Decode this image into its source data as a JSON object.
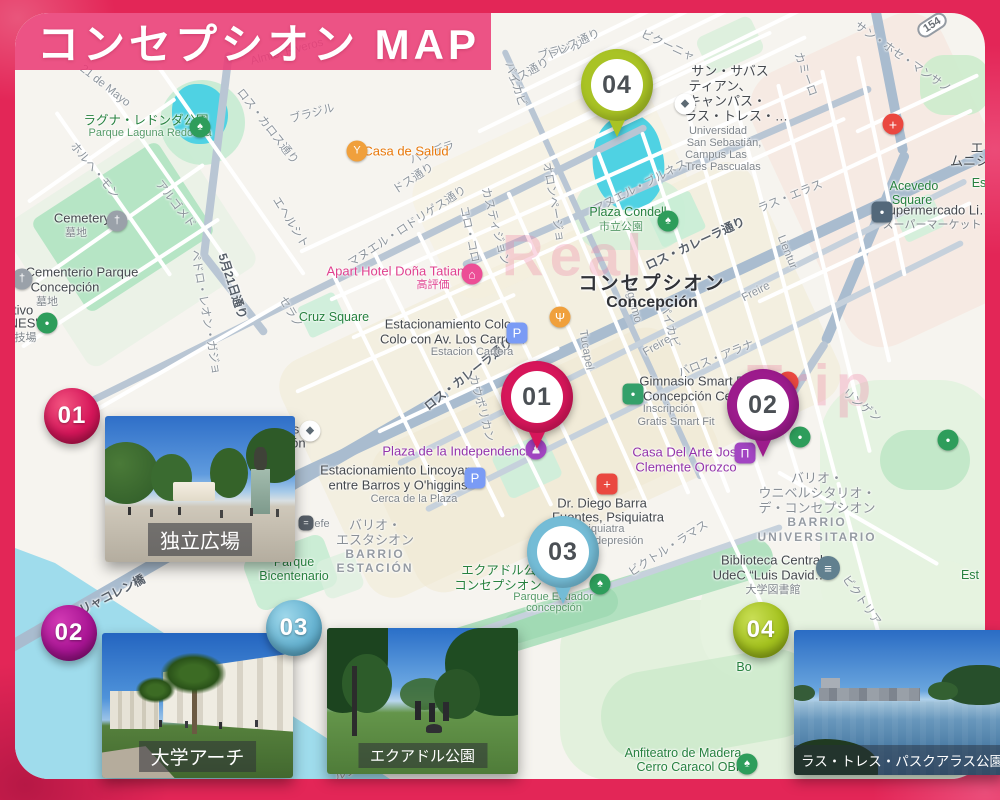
{
  "title": "コンセプシオン MAP",
  "frame_color": "#e32657",
  "banner_color": "#ec3c76",
  "map": {
    "route_shield": "154",
    "watermarks": [
      {
        "text": "Real",
        "x": 575,
        "y": 256
      },
      {
        "text": "Trip",
        "x": 812,
        "y": 386
      }
    ],
    "labels": [
      {
        "t": "21 de Mayo",
        "x": 105,
        "y": 86,
        "r": 38
      },
      {
        "t": "ロス・カロス通り",
        "x": 268,
        "y": 126,
        "r": 52
      },
      {
        "t": "ホルヘ・モン",
        "x": 95,
        "y": 170,
        "r": 50
      },
      {
        "t": "アルゴメド",
        "x": 176,
        "y": 204,
        "r": 52
      },
      {
        "t": "エヘルシト",
        "x": 291,
        "y": 222,
        "r": 58
      },
      {
        "t": "セラノ",
        "x": 291,
        "y": 312,
        "r": 60
      },
      {
        "t": "ペドロ・レオン・ガジョ",
        "x": 206,
        "y": 312,
        "r": 80
      },
      {
        "t": "5月21日通り",
        "x": 233,
        "y": 286,
        "r": 72,
        "c": "std"
      },
      {
        "t": "ドス通り",
        "x": 413,
        "y": 178,
        "r": -33
      },
      {
        "t": "バンデラ",
        "x": 432,
        "y": 152,
        "r": -20
      },
      {
        "t": "ブラジル",
        "x": 312,
        "y": 113,
        "r": -15
      },
      {
        "t": "ブラジル",
        "x": 560,
        "y": 50,
        "r": -15
      },
      {
        "t": "ドス通り",
        "x": 528,
        "y": 72,
        "r": -30
      },
      {
        "t": "トレス通り",
        "x": 573,
        "y": 44,
        "r": -25
      },
      {
        "t": "ビクーニャ",
        "x": 668,
        "y": 45,
        "r": 25
      },
      {
        "t": "カミーロ",
        "x": 806,
        "y": 74,
        "r": 70
      },
      {
        "t": "サン・ホセ・マンサノ",
        "x": 903,
        "y": 57,
        "r": 35
      },
      {
        "t": "パイカビ",
        "x": 516,
        "y": 84,
        "r": 72
      },
      {
        "t": "パイカビ",
        "x": 670,
        "y": 325,
        "r": 75
      },
      {
        "t": "マヌエル・ロドリゲス通り",
        "x": 407,
        "y": 226,
        "r": -33
      },
      {
        "t": "カスティジョン",
        "x": 496,
        "y": 226,
        "r": 75
      },
      {
        "t": "コロ・コロ",
        "x": 470,
        "y": 234,
        "r": 78
      },
      {
        "t": "オロンページョ",
        "x": 554,
        "y": 202,
        "r": 80
      },
      {
        "t": "マヌエル・ブルネス",
        "x": 640,
        "y": 186,
        "r": -27
      },
      {
        "t": "ラス・エラス",
        "x": 790,
        "y": 196,
        "r": -22
      },
      {
        "t": "Lientur",
        "x": 787,
        "y": 252,
        "r": 68
      },
      {
        "t": "Freire",
        "x": 756,
        "y": 292,
        "r": -27
      },
      {
        "t": "Freire",
        "x": 657,
        "y": 346,
        "r": -30
      },
      {
        "t": "バロス・アラナ",
        "x": 716,
        "y": 358,
        "r": -22
      },
      {
        "t": "Ongolmo",
        "x": 632,
        "y": 300,
        "r": 75
      },
      {
        "t": "Tucapel",
        "x": 586,
        "y": 350,
        "r": 80
      },
      {
        "t": "ロス・カレーラ通り",
        "x": 695,
        "y": 243,
        "r": -25,
        "c": "std"
      },
      {
        "t": "ロス・カレーラ通り",
        "x": 468,
        "y": 374,
        "r": -38,
        "c": "std"
      },
      {
        "t": "カウポリカン",
        "x": 482,
        "y": 408,
        "r": 75
      },
      {
        "t": "リャコレン橋",
        "x": 112,
        "y": 594,
        "r": -27,
        "c": "std"
      },
      {
        "t": "ビクトル・ラマス",
        "x": 668,
        "y": 548,
        "r": -33
      },
      {
        "t": "ビクトリア",
        "x": 862,
        "y": 600,
        "r": 55
      },
      {
        "t": "リンゲン",
        "x": 862,
        "y": 405,
        "r": 38
      },
      {
        "t": "ルシーン",
        "x": 356,
        "y": 769,
        "r": -20
      },
      {
        "t": "チャカブコ",
        "x": 258,
        "y": 712,
        "r": -35
      },
      {
        "t": "Almte. Riveros",
        "x": 287,
        "y": 52,
        "r": -15
      },
      {
        "t": "ラグナ・レドンダ公園",
        "x": 146,
        "y": 119,
        "c": "pk"
      },
      {
        "t": "Parque Laguna Redonda",
        "x": 150,
        "y": 133,
        "c": "pks"
      },
      {
        "t": "Cruz Square",
        "x": 334,
        "y": 317,
        "c": "pk"
      },
      {
        "t": "Plaza Condell",
        "x": 628,
        "y": 212,
        "c": "pk"
      },
      {
        "t": "市立公園",
        "x": 621,
        "y": 226,
        "c": "pks"
      },
      {
        "t": "Acevedo",
        "x": 914,
        "y": 186,
        "c": "pk"
      },
      {
        "t": "Square",
        "x": 912,
        "y": 200,
        "c": "pk"
      },
      {
        "t": "Parque",
        "x": 294,
        "y": 562,
        "c": "pk"
      },
      {
        "t": "Bicentenario",
        "x": 294,
        "y": 576,
        "c": "pk"
      },
      {
        "t": "エクアドル公園",
        "x": 505,
        "y": 569,
        "c": "pk"
      },
      {
        "t": "コンセプシオン",
        "x": 498,
        "y": 584,
        "c": "pk"
      },
      {
        "t": "Parque Ecuador",
        "x": 553,
        "y": 597,
        "c": "pks"
      },
      {
        "t": "concepción",
        "x": 554,
        "y": 608,
        "c": "pks"
      },
      {
        "t": "Anfiteatro de Madera",
        "x": 683,
        "y": 753,
        "c": "pk"
      },
      {
        "t": "Cerro Caracol OBF",
        "x": 690,
        "y": 767,
        "c": "pk"
      },
      {
        "t": "Bo",
        "x": 744,
        "y": 667,
        "c": "pk"
      },
      {
        "t": "ster",
        "x": 966,
        "y": 755,
        "c": "pk"
      },
      {
        "t": "Est",
        "x": 970,
        "y": 575,
        "c": "pk"
      },
      {
        "t": "Es",
        "x": 979,
        "y": 183,
        "c": "pk"
      },
      {
        "t": "Cemetery",
        "x": 82,
        "y": 218,
        "c": "poi"
      },
      {
        "t": "墓地",
        "x": 76,
        "y": 232,
        "c": "pois"
      },
      {
        "t": "Cementerio Parque",
        "x": 82,
        "y": 272,
        "c": "poi"
      },
      {
        "t": "Concepción",
        "x": 65,
        "y": 287,
        "c": "poi"
      },
      {
        "t": "墓地",
        "x": 47,
        "y": 301,
        "c": "pois"
      },
      {
        "t": "rtivo",
        "x": 21,
        "y": 310,
        "c": "poi"
      },
      {
        "t": "'NES'",
        "x": 22,
        "y": 323,
        "c": "poi"
      },
      {
        "t": "球技場",
        "x": 20,
        "y": 337,
        "c": "pois"
      },
      {
        "t": "Estacionamiento Colo",
        "x": 448,
        "y": 324,
        "c": "poi"
      },
      {
        "t": "Colo con Av. Los Carrera",
        "x": 452,
        "y": 339,
        "c": "poi"
      },
      {
        "t": "Estacion Carrera",
        "x": 472,
        "y": 352,
        "c": "pois"
      },
      {
        "t": "Estacionamiento Lincoyan",
        "x": 396,
        "y": 470,
        "c": "poi"
      },
      {
        "t": "entre Barros y O'higgins",
        "x": 398,
        "y": 485,
        "c": "poi"
      },
      {
        "t": "Cerca de la Plaza",
        "x": 414,
        "y": 499,
        "c": "pois"
      },
      {
        "t": "to Tomás",
        "x": 273,
        "y": 429,
        "c": "poi"
      },
      {
        "t": "oncepción",
        "x": 276,
        "y": 443,
        "c": "poi"
      },
      {
        "t": "コンセプシオン",
        "x": 652,
        "y": 282,
        "c": "city"
      },
      {
        "t": "Concepción",
        "x": 652,
        "y": 303,
        "c": "city2"
      },
      {
        "t": "サン・サバス",
        "x": 730,
        "y": 70,
        "c": "poi"
      },
      {
        "t": "ティアン、",
        "x": 720,
        "y": 85,
        "c": "poi"
      },
      {
        "t": "キャンパス・",
        "x": 727,
        "y": 100,
        "c": "poi"
      },
      {
        "t": "ラス・トレス・…",
        "x": 736,
        "y": 115,
        "c": "poi"
      },
      {
        "t": "Universidad",
        "x": 718,
        "y": 131,
        "c": "pois"
      },
      {
        "t": "San Sebastián,",
        "x": 724,
        "y": 143,
        "c": "pois"
      },
      {
        "t": "Campus Las",
        "x": 716,
        "y": 155,
        "c": "pois"
      },
      {
        "t": "Tres Pascualas",
        "x": 723,
        "y": 167,
        "c": "pois"
      },
      {
        "t": "Gimnasio Smart Fit",
        "x": 695,
        "y": 381,
        "c": "poi"
      },
      {
        "t": "- Concepción Ce…",
        "x": 690,
        "y": 396,
        "c": "poi"
      },
      {
        "t": "Inscripción",
        "x": 669,
        "y": 409,
        "c": "pois"
      },
      {
        "t": "Gratis Smart Fit",
        "x": 676,
        "y": 422,
        "c": "pois"
      },
      {
        "t": "Dr. Diego Barra",
        "x": 602,
        "y": 503,
        "c": "poi"
      },
      {
        "t": "Fuentes, Psiquiatra",
        "x": 608,
        "y": 517,
        "c": "poi"
      },
      {
        "t": "Psiquiatra",
        "x": 600,
        "y": 529,
        "c": "pois"
      },
      {
        "t": "…dad depresión",
        "x": 603,
        "y": 541,
        "c": "pois"
      },
      {
        "t": "Biblioteca Central",
        "x": 772,
        "y": 560,
        "c": "poi"
      },
      {
        "t": "UdeC “Luis David…",
        "x": 770,
        "y": 575,
        "c": "poi"
      },
      {
        "t": "大学図書館",
        "x": 773,
        "y": 589,
        "c": "pois"
      },
      {
        "t": "Supermercado Li…",
        "x": 936,
        "y": 210,
        "c": "poi"
      },
      {
        "t": "スーパーマーケット",
        "x": 932,
        "y": 224,
        "c": "pois"
      },
      {
        "t": "efe",
        "x": 322,
        "y": 524,
        "c": "pois"
      },
      {
        "t": "エ",
        "x": 977,
        "y": 147,
        "c": "poi"
      },
      {
        "t": "ムニシ…",
        "x": 976,
        "y": 160,
        "c": "poi"
      },
      {
        "t": "Apart Hotel Doña Tatiana",
        "x": 399,
        "y": 271,
        "c": "hot"
      },
      {
        "t": "高評価",
        "x": 433,
        "y": 284,
        "c": "hots"
      },
      {
        "t": "Casa de Salud",
        "x": 406,
        "y": 151,
        "c": "org"
      },
      {
        "t": "Plaza de la Independencia",
        "x": 459,
        "y": 451,
        "c": "pur"
      },
      {
        "t": "Casa Del Arte José",
        "x": 688,
        "y": 452,
        "c": "pur"
      },
      {
        "t": "Clemente Orozco",
        "x": 686,
        "y": 467,
        "c": "pur"
      },
      {
        "t": "バリオ・",
        "x": 817,
        "y": 477,
        "c": "ar"
      },
      {
        "t": "ウニベルシタリオ・",
        "x": 817,
        "y": 492,
        "c": "ar"
      },
      {
        "t": "デ・コンセプシオン",
        "x": 817,
        "y": 507,
        "c": "ar"
      },
      {
        "t": "BARRIO",
        "x": 817,
        "y": 522,
        "c": "ars"
      },
      {
        "t": "UNIVERSITARIO",
        "x": 817,
        "y": 537,
        "c": "ars"
      },
      {
        "t": "バリオ・",
        "x": 375,
        "y": 524,
        "c": "ar"
      },
      {
        "t": "エスタシオン",
        "x": 375,
        "y": 539,
        "c": "ar"
      },
      {
        "t": "BARRIO",
        "x": 375,
        "y": 554,
        "c": "ars"
      },
      {
        "t": "ESTACIÓN",
        "x": 375,
        "y": 568,
        "c": "ars"
      }
    ],
    "icons": [
      {
        "name": "park-tree-icon",
        "g": "♠",
        "x": 200,
        "y": 127,
        "bg": "#2e9d5b"
      },
      {
        "name": "park-tree-icon",
        "g": "♠",
        "x": 668,
        "y": 221,
        "bg": "#2e9d5b"
      },
      {
        "name": "park-tree-icon",
        "g": "♠",
        "x": 600,
        "y": 584,
        "bg": "#2e9d5b"
      },
      {
        "name": "park-tree-icon",
        "g": "♠",
        "x": 747,
        "y": 764,
        "bg": "#2e9d5b"
      },
      {
        "name": "park-dot-icon",
        "g": "●",
        "x": 800,
        "y": 437,
        "bg": "#2e9d5b",
        "fs": 8
      },
      {
        "name": "park-dot-icon",
        "g": "●",
        "x": 948,
        "y": 440,
        "bg": "#2e9d5b",
        "fs": 8
      },
      {
        "name": "sports-dot-icon",
        "g": "●",
        "x": 47,
        "y": 323,
        "bg": "#2e9d5b",
        "fs": 8
      },
      {
        "name": "cemetery-icon",
        "g": "†",
        "x": 117,
        "y": 221,
        "bg": "#9aa1a9"
      },
      {
        "name": "cemetery-icon",
        "g": "†",
        "x": 22,
        "y": 279,
        "bg": "#9aa1a9"
      },
      {
        "name": "university-icon",
        "g": "◆",
        "x": 685,
        "y": 104,
        "bg": "#ffffff",
        "fg": "#5d6a74"
      },
      {
        "name": "university-icon",
        "g": "◆",
        "x": 310,
        "y": 431,
        "bg": "#ffffff",
        "fg": "#5d6a74"
      },
      {
        "name": "hotel-icon",
        "g": "⌂",
        "x": 472,
        "y": 274,
        "bg": "#ec4e96",
        "fs": 12
      },
      {
        "name": "bar-icon",
        "g": "Y",
        "x": 357,
        "y": 151,
        "bg": "#f0a03c",
        "fs": 11
      },
      {
        "name": "restaurant-icon",
        "g": "Ψ",
        "x": 560,
        "y": 317,
        "bg": "#f0a03c",
        "fs": 12
      },
      {
        "name": "hospital-icon",
        "g": "+",
        "x": 893,
        "y": 124,
        "bg": "#ea4840",
        "fs": 14
      },
      {
        "name": "medical-icon",
        "g": "+",
        "x": 607,
        "y": 484,
        "bg": "#ea4840",
        "sq": true,
        "fs": 13
      },
      {
        "name": "restaurant-red-icon",
        "g": "+",
        "x": 788,
        "y": 382,
        "bg": "#ea4840",
        "fs": 12
      },
      {
        "name": "parking-icon",
        "g": "P",
        "x": 517,
        "y": 333,
        "bg": "#7a9bf5",
        "sq": true,
        "fs": 13
      },
      {
        "name": "parking-icon",
        "g": "P",
        "x": 475,
        "y": 478,
        "bg": "#7a9bf5",
        "sq": true,
        "fs": 13
      },
      {
        "name": "supermarket-icon",
        "g": "●",
        "x": 882,
        "y": 212,
        "bg": "#53687a",
        "sq": true,
        "fs": 8
      },
      {
        "name": "gym-icon",
        "g": "●",
        "x": 633,
        "y": 394,
        "bg": "#34a06a",
        "sq": true,
        "fs": 8
      },
      {
        "name": "museum-icon",
        "g": "Π",
        "x": 745,
        "y": 453,
        "bg": "#a245c2",
        "sq": true,
        "fs": 12
      },
      {
        "name": "monument-icon",
        "g": "♟",
        "x": 536,
        "y": 449,
        "bg": "#a245c2",
        "fs": 12
      },
      {
        "name": "library-icon",
        "g": "≡",
        "x": 828,
        "y": 568,
        "bg": "#61808f",
        "s": 24,
        "fs": 13
      },
      {
        "name": "train-icon",
        "g": "=",
        "x": 306,
        "y": 523,
        "bg": "#555d66",
        "sq": true,
        "s": 15,
        "fs": 9
      },
      {
        "name": "police-icon",
        "g": "●",
        "x": 268,
        "y": 521,
        "bg": "#4285f4",
        "s": 23,
        "fs": 9
      },
      {
        "name": "statue-icon",
        "g": "♟",
        "x": 957,
        "y": 657,
        "bg": "#a6adb4",
        "fs": 12
      }
    ]
  },
  "pins": [
    {
      "num": "01",
      "color": "#d6165a"
    },
    {
      "num": "02",
      "color": "#9c1b8c"
    },
    {
      "num": "03",
      "color": "#74bcd6"
    },
    {
      "num": "04",
      "color": "#a9c325"
    }
  ],
  "photos": [
    {
      "num": "01",
      "label": "独立広場",
      "badge_color": "#d6165a"
    },
    {
      "num": "02",
      "label": "大学アーチ",
      "badge_color": "#a91594"
    },
    {
      "num": "03",
      "label": "エクアドル公園",
      "badge_color": "#68b4d2"
    },
    {
      "num": "04",
      "label": "ラス・トレス・パスクアラス公園",
      "badge_color": "#a4c21e"
    }
  ]
}
